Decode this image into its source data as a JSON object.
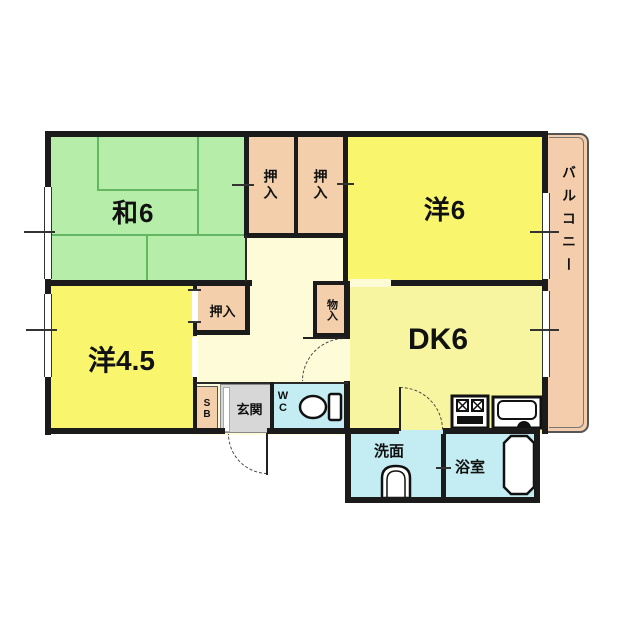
{
  "labels": {
    "washitsu6": "和6",
    "oshiire_top_left": "押入",
    "oshiire_top_right": "押入",
    "yoshitsu6": "洋6",
    "yoshitsu45": "洋4.5",
    "oshiire45": "押入",
    "monoire": "物入",
    "dk6": "DK6",
    "genkan": "玄関",
    "wc": "WC",
    "senmen": "洗面",
    "yokushitsu": "浴室",
    "balcony": "バルコニー",
    "shoebox": "SB"
  },
  "colors": {
    "tatami_room": "#b5eda9",
    "western_room": "#f9f66e",
    "dining_kitchen": "#f8f5a0",
    "hallway": "#fdfbd8",
    "closet": "#f3cfac",
    "balcony": "#f4cdac",
    "wet_area": "#c3edf2",
    "entrance": "#d7d7d7",
    "wall": "#1b1b1b"
  },
  "icons": {
    "toilet": "toilet-icon",
    "washbasin": "washbasin-icon",
    "bathtub": "bathtub-icon",
    "stove": "stove-icon",
    "kitchen_sink": "kitchen-sink-icon"
  }
}
